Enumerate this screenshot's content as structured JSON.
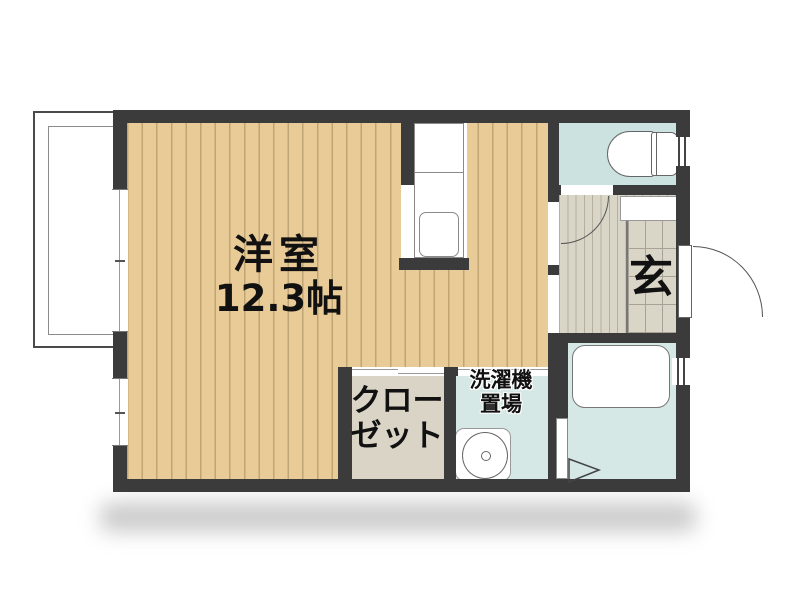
{
  "floorplan": {
    "type": "apartment-room-layout",
    "rooms": {
      "western_room": {
        "name_label": "洋室",
        "size_label": "12.3帖"
      },
      "closet": {
        "label_line1": "クロー",
        "label_line2": "ゼット"
      },
      "laundry": {
        "label_line1": "洗濯機",
        "label_line2": "置場"
      },
      "entrance": {
        "label": "玄"
      },
      "balcony": {
        "label": ""
      },
      "toilet": {
        "label": ""
      },
      "bathroom": {
        "label": ""
      }
    },
    "colors": {
      "wall": "#3b3b3b",
      "wood_floor": "#e9cb97",
      "wood_stripe": "#bfa474",
      "wet_area_floor": "#d6e8e5",
      "toilet_floor": "#cbe2e0",
      "hall_floor": "#d9d5c7",
      "closet_floor": "#d9d4c6",
      "background": "#ffffff"
    }
  }
}
